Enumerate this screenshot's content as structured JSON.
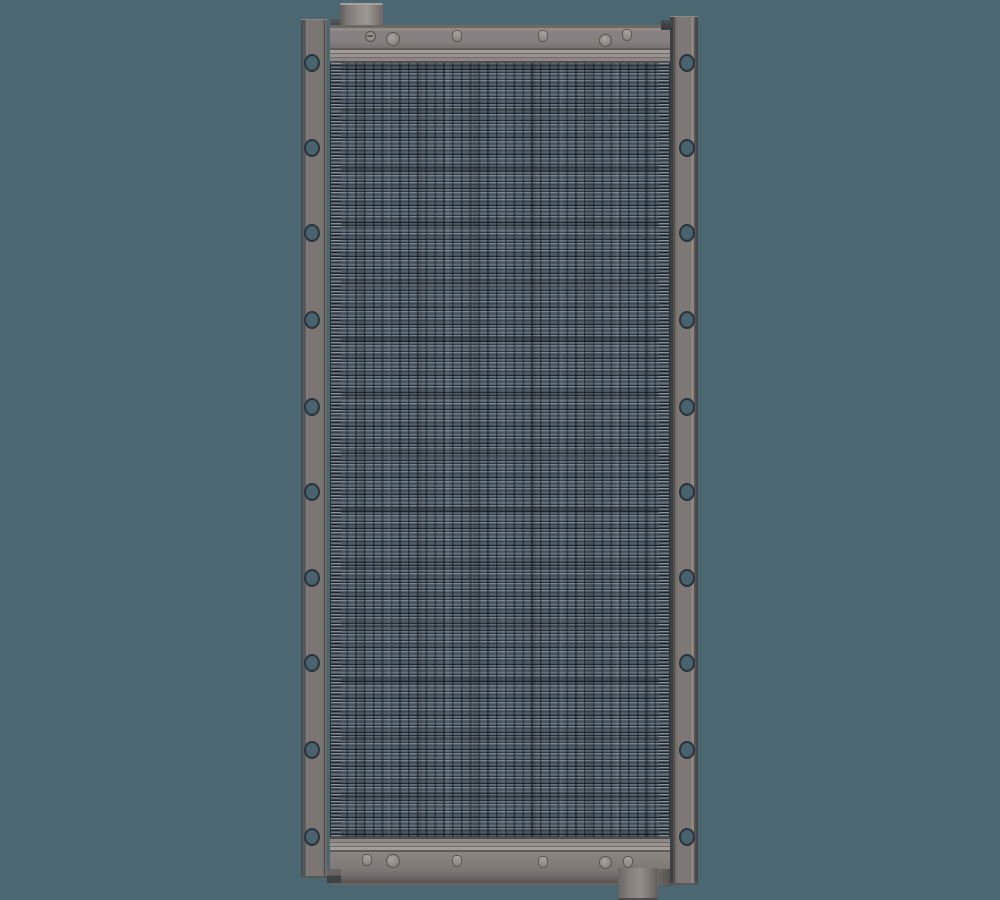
{
  "scene": {
    "type": "3d-cad-render",
    "subject": "radiator-heat-exchanger-front-view",
    "width": 1000,
    "height": 900
  },
  "colors": {
    "background": "#4b6772",
    "bracket_face": "#7b7673",
    "bracket_edge_dark": "#43464a",
    "tank_face": "#868180",
    "ridge_light": "#a29d99",
    "ridge_dark": "#5f5b58",
    "core_base": "#4d5d68",
    "fin_highlight": "#7d8791",
    "fin_mid": "#52626d",
    "fin_dark": "#20272f",
    "hole_fill": "#48626e",
    "hole_rim": "#2b333a",
    "bolt_light": "#a8a39e",
    "bolt_outline": "#5b5754",
    "pipe_light": "#9d9894",
    "pipe_dark": "#605c59"
  },
  "layout": {
    "filler_neck": {
      "x": 340,
      "y": 3,
      "w": 43,
      "h": 25
    },
    "top_tank_face": {
      "x": 330,
      "y": 25,
      "w": 340,
      "h": 23
    },
    "top_header_band": {
      "x": 330,
      "y": 48,
      "w": 340,
      "h": 15
    },
    "core": {
      "x": 330,
      "y": 63,
      "w": 340,
      "h": 774
    },
    "core_edge_left": {
      "x": 331,
      "y": 63,
      "w": 10,
      "h": 774
    },
    "core_edge_right": {
      "x": 659,
      "y": 63,
      "w": 10,
      "h": 774
    },
    "bottom_header_band": {
      "x": 330,
      "y": 837,
      "w": 340,
      "h": 15
    },
    "bottom_tank_face": {
      "x": 330,
      "y": 852,
      "w": 340,
      "h": 33
    },
    "outlet_pipe": {
      "x": 618,
      "y": 868,
      "w": 40,
      "h": 32
    },
    "left_bracket": {
      "x": 301,
      "y": 19,
      "w": 26,
      "h": 859
    },
    "right_bracket": {
      "x": 670,
      "y": 16,
      "w": 28,
      "h": 869
    },
    "neck_tab": {
      "x": 331,
      "y": 19,
      "w": 9,
      "h": 10
    },
    "right_notch": {
      "x": 661,
      "y": 20,
      "w": 11,
      "h": 10
    },
    "left_foot": {
      "x": 327,
      "y": 869,
      "w": 14,
      "h": 14
    },
    "pipe_tab": {
      "x": 657,
      "y": 869,
      "w": 15,
      "h": 17
    }
  },
  "bracket_holes": {
    "y_centers": [
      63,
      148,
      233,
      320,
      407,
      492,
      578,
      663,
      750,
      837
    ],
    "left_cx": 312,
    "right_cx": 687,
    "rx": 8,
    "ry": 9
  },
  "top_bolts": [
    {
      "type": "slot-screw",
      "x": 370,
      "y": 36,
      "d": 11
    },
    {
      "type": "boss",
      "x": 393,
      "y": 39,
      "d": 14
    },
    {
      "type": "cap",
      "x": 457,
      "y": 36,
      "d": 10
    },
    {
      "type": "cap",
      "x": 543,
      "y": 36,
      "d": 10
    },
    {
      "type": "boss",
      "x": 605,
      "y": 40,
      "d": 13
    },
    {
      "type": "cap",
      "x": 627,
      "y": 35,
      "d": 10
    }
  ],
  "bottom_bolts": [
    {
      "type": "cap",
      "x": 367,
      "y": 860,
      "d": 10
    },
    {
      "type": "boss",
      "x": 393,
      "y": 861,
      "d": 14
    },
    {
      "type": "cap",
      "x": 457,
      "y": 861,
      "d": 10
    },
    {
      "type": "cap",
      "x": 543,
      "y": 862,
      "d": 10
    },
    {
      "type": "boss",
      "x": 605,
      "y": 862,
      "d": 13
    },
    {
      "type": "cap",
      "x": 628,
      "y": 862,
      "d": 10
    }
  ]
}
